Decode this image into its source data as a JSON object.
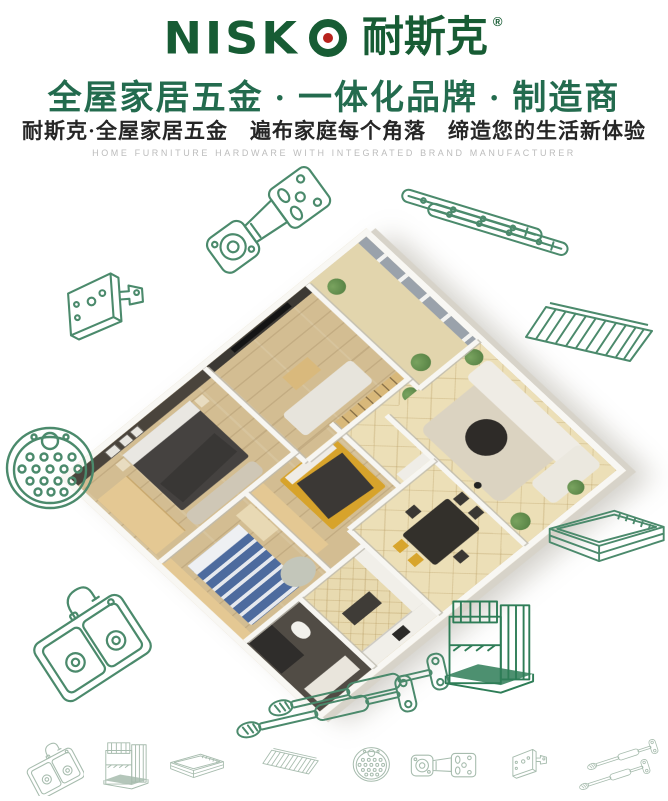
{
  "brand": {
    "latin": "NISK",
    "cjk": "耐斯克",
    "registered": "®"
  },
  "headline": {
    "text": "全屋家居五金 · 一体化品牌 · 制造商"
  },
  "subheadline": {
    "text": "耐斯克·全屋家居五金　遍布家庭每个角落　缔造您的生活新体验"
  },
  "tagline": {
    "text": "HOME FURNITURE HARDWARE WITH INTEGRATED BRAND MANUFACTURER"
  },
  "colors": {
    "brand_green": "#175c34",
    "headline_green": "#236b4e",
    "subheadline_dark": "#262626",
    "tagline_gray": "#bcbcbc",
    "line_art_green": "#4b8a6c",
    "bottom_icon_green": "#a7bcae",
    "logo_dot_red": "#b7221c"
  },
  "icons": {
    "large_art": [
      "cabinet-hinge",
      "drawer-slides",
      "corner-bracket",
      "wire-shelf",
      "perforated-drain-plate",
      "pull-out-basket",
      "kitchen-sink",
      "gas-lift-springs",
      "wire-storage-rack"
    ],
    "bottom_row": [
      "kitchen-sink",
      "wire-storage-rack",
      "pull-out-basket",
      "wire-shelf",
      "perforated-drain-plate",
      "cabinet-hinge",
      "corner-bracket",
      "gas-lift-springs"
    ]
  }
}
